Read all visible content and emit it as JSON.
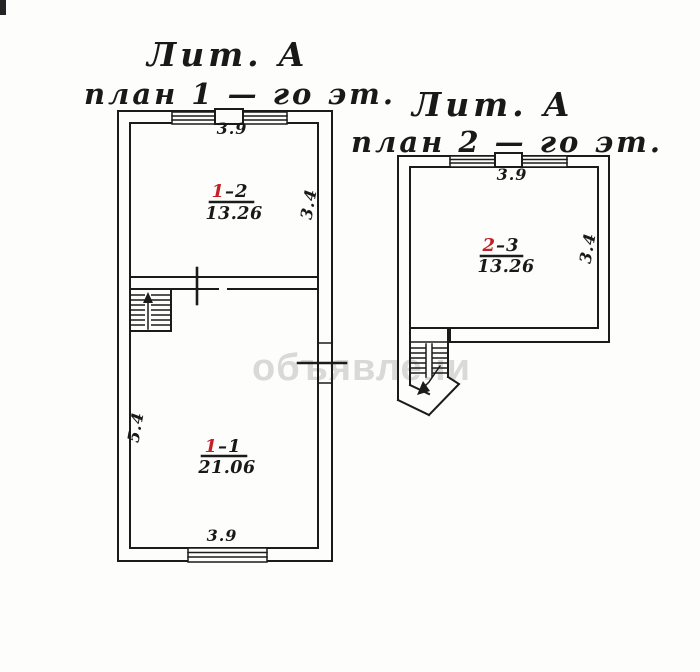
{
  "watermark": {
    "text": "объявлени",
    "color": "#d9d9d9"
  },
  "colors": {
    "ink": "#1b1b1b",
    "room_number_red": "#c32128",
    "paper": "#fdfdfb"
  },
  "left_plan": {
    "title_line1": "Лит.  А",
    "title_line2": "план 1 — го эт.",
    "rooms": [
      {
        "num_red": "1",
        "num_rest": "–2",
        "area": "13.26"
      },
      {
        "num_red": "1",
        "num_rest": "–1",
        "area": "21.06"
      }
    ],
    "dims": {
      "top": "3.9",
      "right": "3.4",
      "left": "5.4",
      "bottom": "3.9"
    }
  },
  "right_plan": {
    "title_line1": "Лит.  А",
    "title_line2": "план 2 — го эт.",
    "rooms": [
      {
        "num_red": "2",
        "num_rest": "–3",
        "area": "13.26"
      }
    ],
    "dims": {
      "top": "3.9",
      "right": "3.4"
    }
  }
}
